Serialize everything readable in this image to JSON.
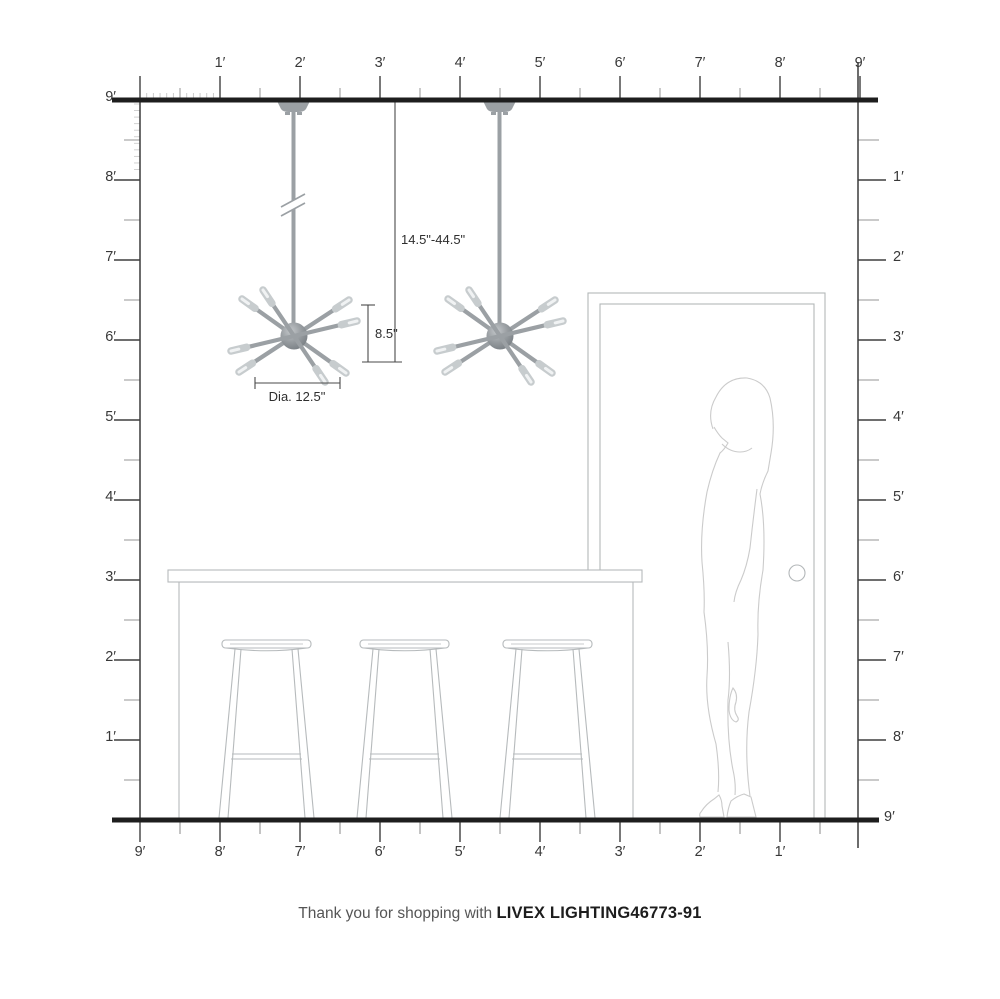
{
  "rulers": {
    "top": {
      "labels": [
        "1′",
        "2′",
        "3′",
        "4′",
        "5′",
        "6′",
        "7′",
        "8′",
        "9′"
      ]
    },
    "left": {
      "labels": [
        "9′",
        "8′",
        "7′",
        "6′",
        "5′",
        "4′",
        "3′",
        "2′",
        "1′"
      ]
    },
    "right": {
      "labels": [
        "1′",
        "2′",
        "3′",
        "4′",
        "5′",
        "6′",
        "7′",
        "8′",
        "9′"
      ]
    },
    "bottom": {
      "labels": [
        "9′",
        "8′",
        "7′",
        "6′",
        "5′",
        "4′",
        "3′",
        "2′",
        "1′"
      ]
    }
  },
  "dimensions": {
    "drop_range": "14.5\"-44.5\"",
    "fixture_height": "8.5\"",
    "fixture_diameter": "Dia. 12.5\""
  },
  "caption": {
    "prefix": "Thank you for shopping with ",
    "brand": "LIVEX LIGHTING46773-91"
  },
  "colors": {
    "structure_dark": "#1e1e1e",
    "wall_line": "#3c3c3c",
    "tick_major": "#3f3f3f",
    "tick_minor": "#949494",
    "fixture_gray": "#9ba0a4",
    "bulb_tip": "#c7ccce",
    "furniture_line": "#b6babc",
    "person_line": "#cbcbcb",
    "dimension_line": "#4a4a4a"
  }
}
